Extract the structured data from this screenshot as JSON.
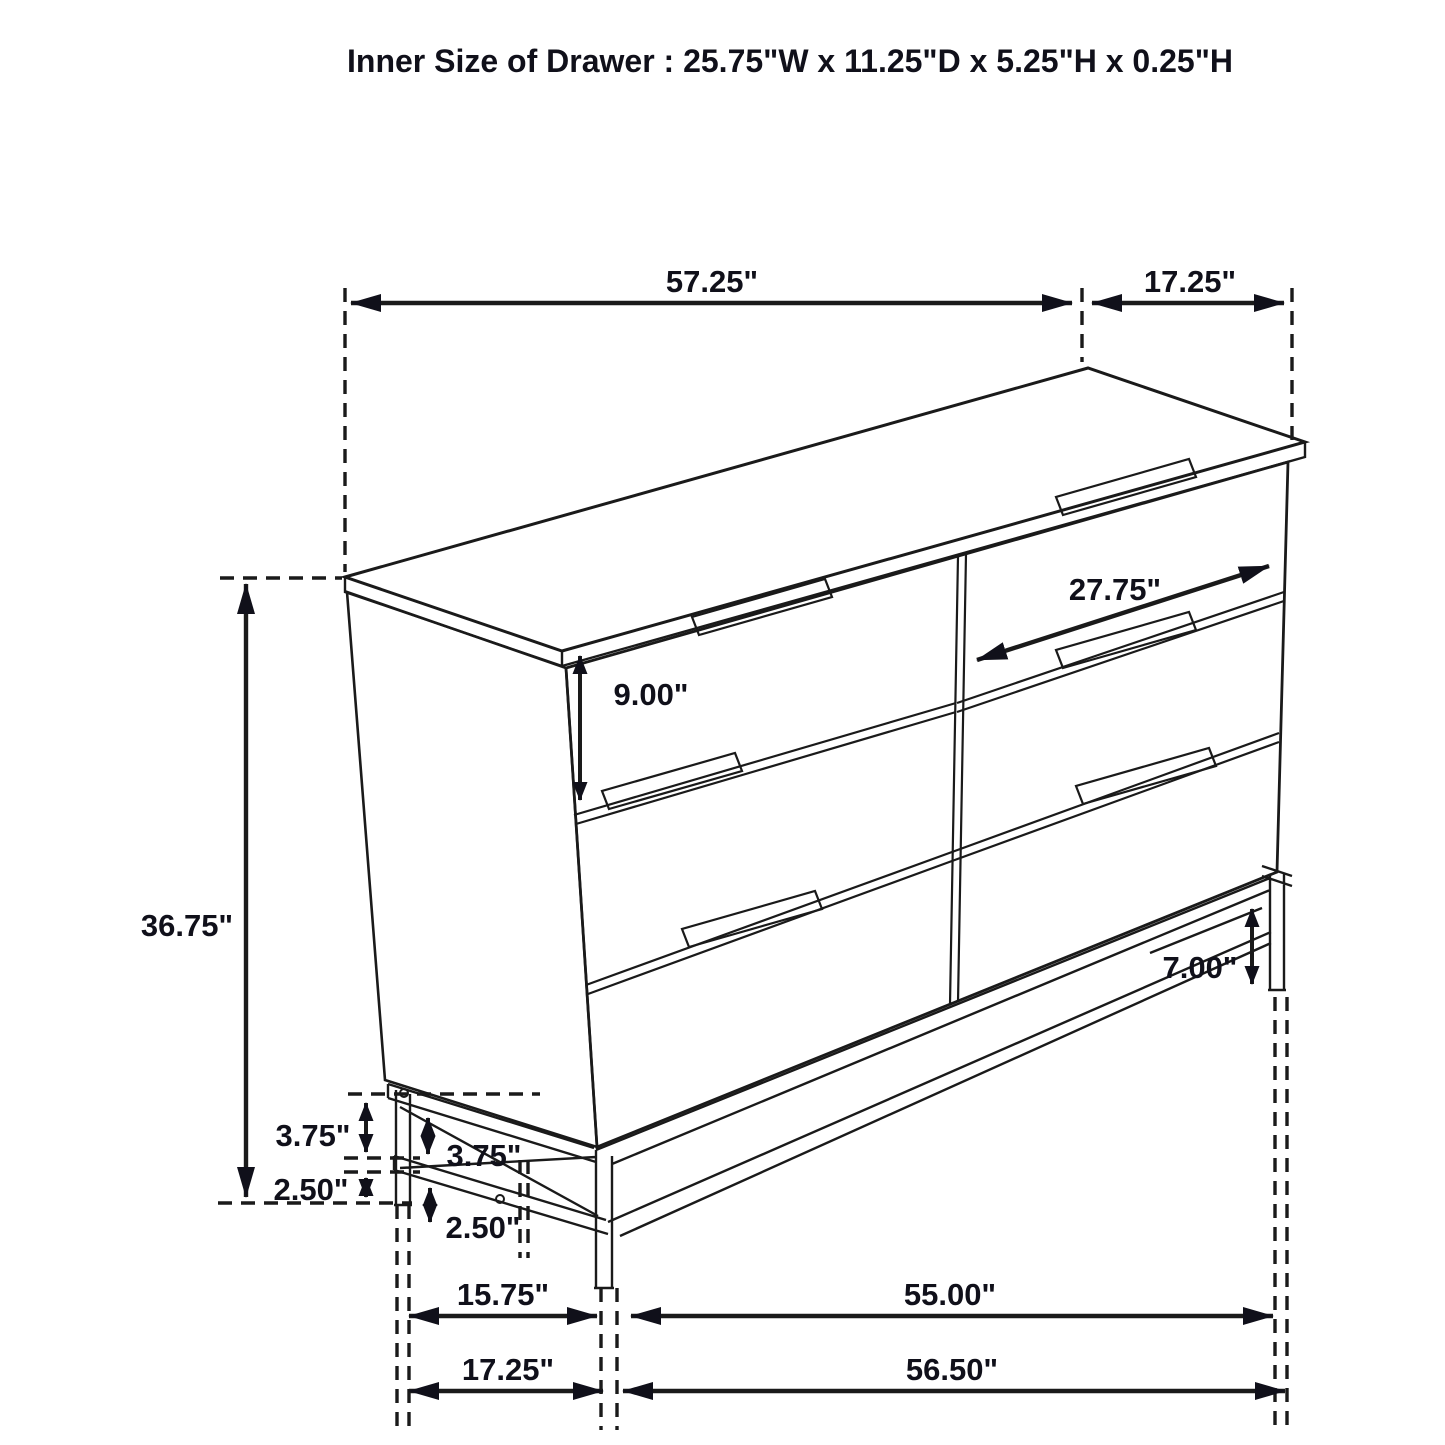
{
  "title": "Inner Size of Drawer : 25.75\"W x 11.25\"D x 5.25\"H x 0.25\"H",
  "dimensions": {
    "top_width": "57.25\"",
    "top_depth": "17.25\"",
    "overall_height": "36.75\"",
    "drawer_front_height": "9.00\"",
    "drawer_width": "27.75\"",
    "base_height_right": "7.00\"",
    "base_rail_height_side": "3.75\"",
    "base_rail_height_front": "3.75\"",
    "leg_lower_height_side": "2.50\"",
    "leg_lower_height_front": "2.50\"",
    "leg_span_side_inner": "15.75\"",
    "leg_span_front_inner": "55.00\"",
    "base_depth_outer": "17.25\"",
    "base_width_outer": "56.50\""
  }
}
